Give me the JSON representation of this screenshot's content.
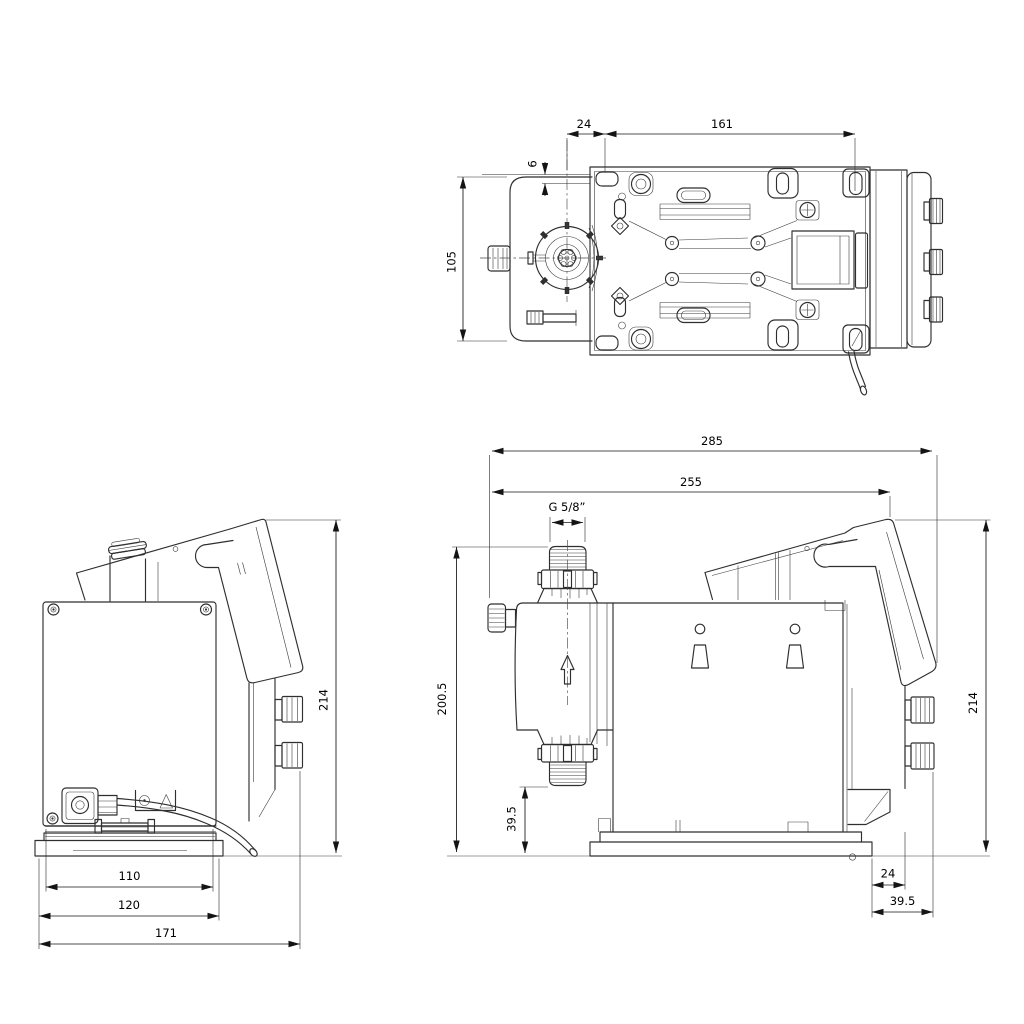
{
  "drawing": {
    "background": "#ffffff",
    "line_color": "#2f2f2f",
    "dimension_color": "#141414",
    "views": {
      "top_view": {
        "dimensions": [
          {
            "id": "valve-to-plate-24",
            "label": "24"
          },
          {
            "id": "mounting-span-161",
            "label": "161"
          },
          {
            "id": "edge-offset-6",
            "label": "6"
          },
          {
            "id": "body-depth-105",
            "label": "105"
          }
        ]
      },
      "front_view": {
        "dimensions": [
          {
            "id": "overall-height-214",
            "label": "214"
          },
          {
            "id": "panel-width-110",
            "label": "110"
          },
          {
            "id": "base-width-120",
            "label": "120"
          },
          {
            "id": "overall-width-171",
            "label": "171"
          }
        ]
      },
      "side_view": {
        "dimensions": [
          {
            "id": "overall-length-285",
            "label": "285"
          },
          {
            "id": "length-to-panel-255",
            "label": "255"
          },
          {
            "id": "thread-size",
            "label": "G 5/8”"
          },
          {
            "id": "discharge-height-200-5",
            "label": "200.5"
          },
          {
            "id": "suction-height-39-5",
            "label": "39.5"
          },
          {
            "id": "overall-height-214",
            "label": "214"
          },
          {
            "id": "base-offset-24",
            "label": "24"
          },
          {
            "id": "rear-offset-39-5",
            "label": "39.5"
          }
        ]
      }
    }
  }
}
